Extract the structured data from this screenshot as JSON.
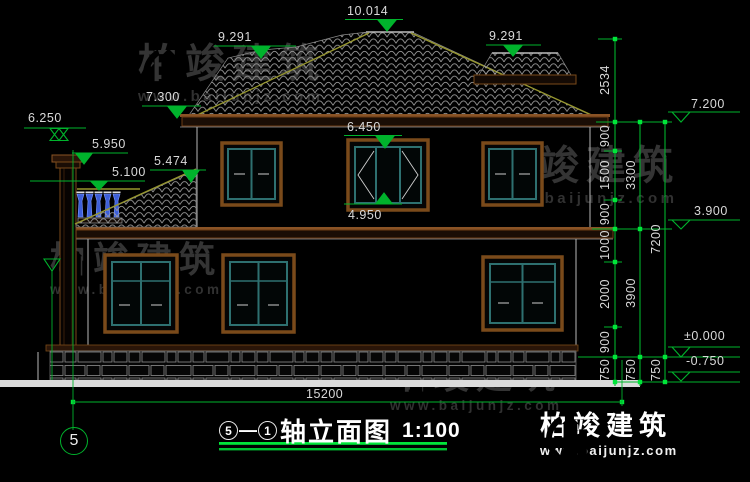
{
  "watermark": {
    "brand": "柏竣建筑",
    "site": "www.baijunjz.com"
  },
  "levels": {
    "ridge": "10.014",
    "roof_left": "9.291",
    "roof_right": "9.291",
    "eave_left": "7.300",
    "chimney_top": "6.250",
    "chimney_cap": "5.950",
    "porch_roof": "5.474",
    "railing": "5.100",
    "window_head": "6.450",
    "window_sill": "4.950",
    "eave_right": "7.200",
    "floor2": "3.900",
    "ground": "±0.000",
    "footing": "-0.750"
  },
  "dims": {
    "col1": [
      "2534",
      "900",
      "1500",
      "900",
      "1000",
      "2000",
      "900",
      "750"
    ],
    "col2": [
      "3300",
      "3900",
      "750"
    ],
    "col3": [
      "7200",
      "750"
    ],
    "total_width": "15200"
  },
  "title": {
    "axis_a": "5",
    "dash": "—",
    "axis_b": "1",
    "name": "轴立面图",
    "scale": "1:100"
  },
  "axis_bubble": "5"
}
